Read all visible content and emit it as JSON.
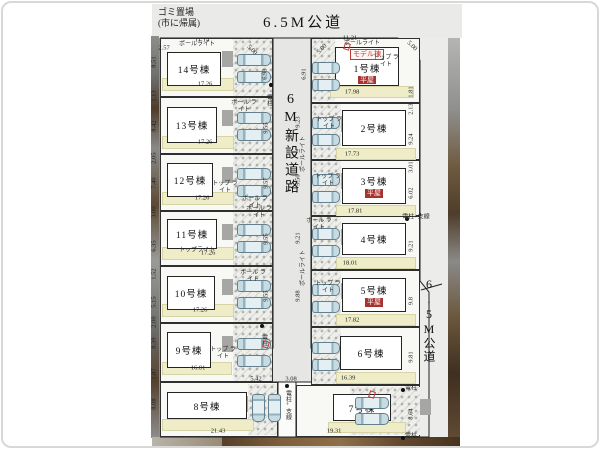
{
  "legend": {
    "garbage_line1": "ゴミ置場",
    "garbage_line2": "(市に帰属)",
    "road_top": "6.5M公道",
    "road_center": "6M新設道路",
    "road_right": "6.5M公道"
  },
  "badges": {
    "model": "モデル棟",
    "hiraya": "平屋"
  },
  "colors": {
    "hiraya_red": "#a8322e",
    "model_red": "#bb3b35",
    "garden_yellow": "#eeedc8",
    "road_gray": "#e6e6e4"
  },
  "lots": [
    {
      "label": "14号棟",
      "frontage": "17.26",
      "region": [
        160,
        38,
        113,
        59
      ],
      "house": [
        167,
        52,
        54,
        34
      ],
      "garden": [
        162,
        78,
        72,
        13
      ],
      "dim_pos": [
        205,
        84
      ],
      "cars": [
        [
          237,
          54,
          34,
          12
        ],
        [
          237,
          71,
          34,
          12
        ]
      ],
      "park": [
        233,
        39,
        39,
        57
      ],
      "side": "L"
    },
    {
      "label": "13号棟",
      "frontage": "17.26",
      "region": [
        160,
        97,
        113,
        57
      ],
      "house": [
        167,
        107,
        50,
        36
      ],
      "garden": [
        162,
        136,
        72,
        13
      ],
      "dim_pos": [
        205,
        142
      ],
      "cars": [
        [
          237,
          112,
          34,
          12
        ],
        [
          237,
          129,
          34,
          12
        ]
      ],
      "park": [
        233,
        98,
        39,
        55
      ],
      "side": "L"
    },
    {
      "label": "12号棟",
      "frontage": "17.26",
      "region": [
        160,
        154,
        113,
        57
      ],
      "house": [
        167,
        163,
        46,
        34
      ],
      "garden": [
        162,
        192,
        72,
        13
      ],
      "dim_pos": [
        202,
        198
      ],
      "cars": [
        [
          237,
          168,
          34,
          12
        ],
        [
          237,
          185,
          34,
          12
        ]
      ],
      "park": [
        233,
        155,
        39,
        55
      ],
      "side": "L"
    },
    {
      "label": "11号棟",
      "frontage": "17.26",
      "region": [
        160,
        211,
        113,
        55
      ],
      "house": [
        167,
        219,
        50,
        30
      ],
      "garden": [
        162,
        247,
        72,
        13
      ],
      "dim_pos": [
        208,
        253
      ],
      "cars": [
        [
          237,
          224,
          34,
          12
        ],
        [
          237,
          241,
          34,
          12
        ]
      ],
      "park": [
        233,
        212,
        39,
        53
      ],
      "side": "L"
    },
    {
      "label": "10号棟",
      "frontage": "17.26",
      "region": [
        160,
        266,
        113,
        57
      ],
      "house": [
        167,
        276,
        48,
        34
      ],
      "garden": [
        162,
        304,
        72,
        13
      ],
      "dim_pos": [
        200,
        310
      ],
      "cars": [
        [
          237,
          280,
          34,
          12
        ],
        [
          237,
          297,
          34,
          12
        ]
      ],
      "park": [
        233,
        267,
        39,
        55
      ],
      "side": "L"
    },
    {
      "label": "9号棟",
      "frontage": "16.01",
      "region": [
        160,
        323,
        113,
        59
      ],
      "house": [
        167,
        332,
        44,
        36
      ],
      "garden": [
        162,
        362,
        70,
        13
      ],
      "dim_pos": [
        198,
        368
      ],
      "cars": [
        [
          237,
          338,
          34,
          12
        ],
        [
          237,
          355,
          34,
          12
        ]
      ],
      "park": [
        233,
        324,
        39,
        57
      ],
      "side": "L"
    },
    {
      "label": "8号棟",
      "frontage": null,
      "region": [
        160,
        382,
        118,
        55
      ],
      "house": [
        167,
        392,
        80,
        27
      ],
      "garden": [
        162,
        419,
        92,
        12
      ],
      "dim_pos": null,
      "cars": [
        [
          252,
          394,
          13,
          28
        ],
        [
          268,
          394,
          13,
          28
        ]
      ],
      "park": [
        248,
        384,
        29,
        51
      ],
      "side": "L"
    },
    {
      "label": "1号棟",
      "model": 1,
      "hiraya": 1,
      "frontage": "17.98",
      "region": [
        311,
        38,
        109,
        65
      ],
      "house": [
        335,
        47,
        64,
        39
      ],
      "garden": [
        330,
        86,
        84,
        12
      ],
      "dim_pos": [
        352,
        92
      ],
      "cars": [
        [
          312,
          62,
          28,
          12
        ],
        [
          312,
          79,
          28,
          12
        ]
      ],
      "park": [
        312,
        39,
        23,
        62
      ],
      "side": "R"
    },
    {
      "label": "2号棟",
      "frontage": "17.73",
      "region": [
        311,
        103,
        109,
        57
      ],
      "house": [
        342,
        110,
        64,
        36
      ],
      "garden": [
        336,
        148,
        80,
        12
      ],
      "dim_pos": [
        352,
        154
      ],
      "cars": [
        [
          312,
          117,
          28,
          12
        ],
        [
          312,
          134,
          28,
          12
        ]
      ],
      "park": [
        312,
        104,
        29,
        55
      ],
      "side": "R"
    },
    {
      "label": "3号棟",
      "hiraya": 1,
      "frontage": "17.81",
      "region": [
        311,
        160,
        109,
        56
      ],
      "house": [
        342,
        168,
        64,
        36
      ],
      "garden": [
        336,
        205,
        80,
        12
      ],
      "dim_pos": [
        355,
        211
      ],
      "cars": [
        [
          312,
          174,
          28,
          12
        ],
        [
          312,
          191,
          28,
          12
        ]
      ],
      "park": [
        312,
        161,
        29,
        54
      ],
      "side": "R"
    },
    {
      "label": "4号棟",
      "frontage": "18.01",
      "region": [
        311,
        216,
        109,
        54
      ],
      "house": [
        342,
        223,
        64,
        32
      ],
      "garden": [
        336,
        257,
        80,
        12
      ],
      "dim_pos": [
        350,
        263
      ],
      "cars": [
        [
          312,
          228,
          28,
          12
        ],
        [
          312,
          245,
          28,
          12
        ]
      ],
      "park": [
        312,
        217,
        29,
        52
      ],
      "side": "R"
    },
    {
      "label": "5号棟",
      "hiraya": 1,
      "frontage": "17.82",
      "region": [
        311,
        270,
        109,
        57
      ],
      "house": [
        342,
        278,
        64,
        34
      ],
      "garden": [
        336,
        314,
        80,
        12
      ],
      "dim_pos": [
        352,
        320
      ],
      "cars": [
        [
          312,
          284,
          28,
          12
        ],
        [
          312,
          301,
          28,
          12
        ]
      ],
      "park": [
        312,
        271,
        29,
        55
      ],
      "side": "R"
    },
    {
      "label": "6号棟",
      "frontage": "16.39",
      "region": [
        311,
        327,
        109,
        58
      ],
      "house": [
        340,
        336,
        62,
        34
      ],
      "garden": [
        336,
        372,
        80,
        12
      ],
      "dim_pos": [
        348,
        378
      ],
      "cars": [
        [
          312,
          342,
          28,
          12
        ],
        [
          312,
          359,
          28,
          12
        ]
      ],
      "park": [
        312,
        328,
        29,
        56
      ],
      "side": "R"
    },
    {
      "label": "7号棟",
      "frontage": null,
      "region": [
        296,
        385,
        124,
        52
      ],
      "house": [
        333,
        394,
        58,
        27
      ],
      "garden": [
        328,
        422,
        78,
        11
      ],
      "dim_pos": null,
      "cars": [
        [
          355,
          397,
          34,
          12
        ],
        [
          355,
          413,
          34,
          12
        ]
      ],
      "park": [
        350,
        387,
        70,
        48
      ],
      "side": "R"
    }
  ],
  "annotations": {
    "dims": [
      {
        "t": "2.57",
        "x": 164,
        "y": 48
      },
      {
        "t": "11.14",
        "x": 202,
        "y": 40
      },
      {
        "t": "11.21",
        "x": 350,
        "y": 38
      },
      {
        "t": "5.00",
        "x": 252,
        "y": 50,
        "a": 45
      },
      {
        "t": "5.00",
        "x": 322,
        "y": 49,
        "a": -45
      },
      {
        "t": "5.00",
        "x": 412,
        "y": 46,
        "a": 45
      },
      {
        "t": "8.51",
        "x": 154,
        "y": 62,
        "v": 1
      },
      {
        "t": "1.13",
        "x": 154,
        "y": 96,
        "v": 1
      },
      {
        "t": "8.42",
        "x": 154,
        "y": 126,
        "v": 1
      },
      {
        "t": "2.05",
        "x": 154,
        "y": 158,
        "v": 1
      },
      {
        "t": "7.40",
        "x": 154,
        "y": 183,
        "v": 1
      },
      {
        "t": "3.00",
        "x": 154,
        "y": 212,
        "v": 1
      },
      {
        "t": "6.35",
        "x": 154,
        "y": 246,
        "v": 1
      },
      {
        "t": "1.52",
        "x": 154,
        "y": 274,
        "v": 1
      },
      {
        "t": "5.15",
        "x": 154,
        "y": 302,
        "v": 1
      },
      {
        "t": "2.00",
        "x": 154,
        "y": 322,
        "v": 1
      },
      {
        "t": "8.39",
        "x": 154,
        "y": 343,
        "v": 1
      },
      {
        "t": "1.87",
        "x": 154,
        "y": 374,
        "v": 1
      },
      {
        "t": "8.08",
        "x": 154,
        "y": 404,
        "v": 1
      },
      {
        "t": "6.93",
        "x": 265,
        "y": 74,
        "v": 1
      },
      {
        "t": "6.91",
        "x": 304,
        "y": 74,
        "v": 1
      },
      {
        "t": "9.55",
        "x": 266,
        "y": 128,
        "v": 1
      },
      {
        "t": "9.57",
        "x": 266,
        "y": 183,
        "v": 1
      },
      {
        "t": "9.55",
        "x": 266,
        "y": 239,
        "v": 1
      },
      {
        "t": "9.55",
        "x": 266,
        "y": 296,
        "v": 1
      },
      {
        "t": "9.23",
        "x": 298,
        "y": 122,
        "v": 1
      },
      {
        "t": "9.50",
        "x": 298,
        "y": 180,
        "v": 1
      },
      {
        "t": "9.21",
        "x": 298,
        "y": 238,
        "v": 1
      },
      {
        "t": "9.88",
        "x": 298,
        "y": 296,
        "v": 1
      },
      {
        "t": "5.42",
        "x": 256,
        "y": 379
      },
      {
        "t": "3.08",
        "x": 291,
        "y": 379
      },
      {
        "t": "1.81",
        "x": 411,
        "y": 92,
        "v": 1
      },
      {
        "t": "2.13",
        "x": 411,
        "y": 109,
        "v": 1
      },
      {
        "t": "9.24",
        "x": 411,
        "y": 139,
        "v": 1
      },
      {
        "t": "3.01",
        "x": 411,
        "y": 167,
        "v": 1
      },
      {
        "t": "6.02",
        "x": 411,
        "y": 193,
        "v": 1
      },
      {
        "t": "9.21",
        "x": 411,
        "y": 246,
        "v": 1
      },
      {
        "t": "9.8",
        "x": 411,
        "y": 301,
        "v": 1
      },
      {
        "t": "9.81",
        "x": 411,
        "y": 357,
        "v": 1
      },
      {
        "t": "8.64",
        "x": 411,
        "y": 414,
        "v": 1
      },
      {
        "t": "21.43",
        "x": 218,
        "y": 431
      },
      {
        "t": "19.31",
        "x": 334,
        "y": 431
      }
    ],
    "notes": [
      {
        "t": "ポールライト",
        "x": 197,
        "y": 45
      },
      {
        "t": "ポール ライト",
        "x": 244,
        "y": 107,
        "w": 26
      },
      {
        "t": "トップ ライト",
        "x": 225,
        "y": 188,
        "w": 26
      },
      {
        "t": "ポール ライト",
        "x": 255,
        "y": 203,
        "w": 26
      },
      {
        "t": "トップライト",
        "x": 197,
        "y": 251
      },
      {
        "t": "ポール ライト",
        "x": 253,
        "y": 277,
        "w": 26
      },
      {
        "t": "トップ ライト",
        "x": 223,
        "y": 354,
        "w": 26
      },
      {
        "t": "ポールライト",
        "x": 362,
        "y": 44
      },
      {
        "t": "トップ ライト",
        "x": 386,
        "y": 62,
        "w": 26
      },
      {
        "t": "トップ ライト",
        "x": 329,
        "y": 124,
        "w": 26
      },
      {
        "t": "トップ ライト",
        "x": 328,
        "y": 181,
        "w": 26
      },
      {
        "t": "ポール ライト",
        "x": 319,
        "y": 225,
        "w": 26
      },
      {
        "t": "トップ ライト",
        "x": 328,
        "y": 288,
        "w": 26
      },
      {
        "t": "ポール ライト",
        "x": 259,
        "y": 213,
        "w": 26
      },
      {
        "t": "ポールライト",
        "x": 304,
        "y": 154,
        "v": 1
      },
      {
        "t": "ポールライト",
        "x": 304,
        "y": 268,
        "v": 1
      }
    ],
    "poles": [
      {
        "t": "電柱",
        "x": 268,
        "y": 94,
        "vj": 1,
        "dx": 271,
        "dy": 85
      },
      {
        "t": "電柱",
        "x": 263,
        "y": 334,
        "vj": 1,
        "dx": 262,
        "dy": 326
      },
      {
        "t": "電柱+支線",
        "x": 416,
        "y": 218,
        "dx": 407,
        "dy": 219
      },
      {
        "t": "電柱",
        "x": 411,
        "y": 389,
        "dx": 403,
        "dy": 390
      },
      {
        "t": "電柱",
        "x": 411,
        "y": 437,
        "dx": 403,
        "dy": 438
      },
      {
        "t": "電柱+支線",
        "x": 287,
        "y": 390,
        "vj": 1,
        "dx": 287,
        "dy": 386
      }
    ],
    "marks": [
      [
        263,
        341
      ],
      [
        369,
        391
      ],
      [
        344,
        43
      ]
    ]
  }
}
